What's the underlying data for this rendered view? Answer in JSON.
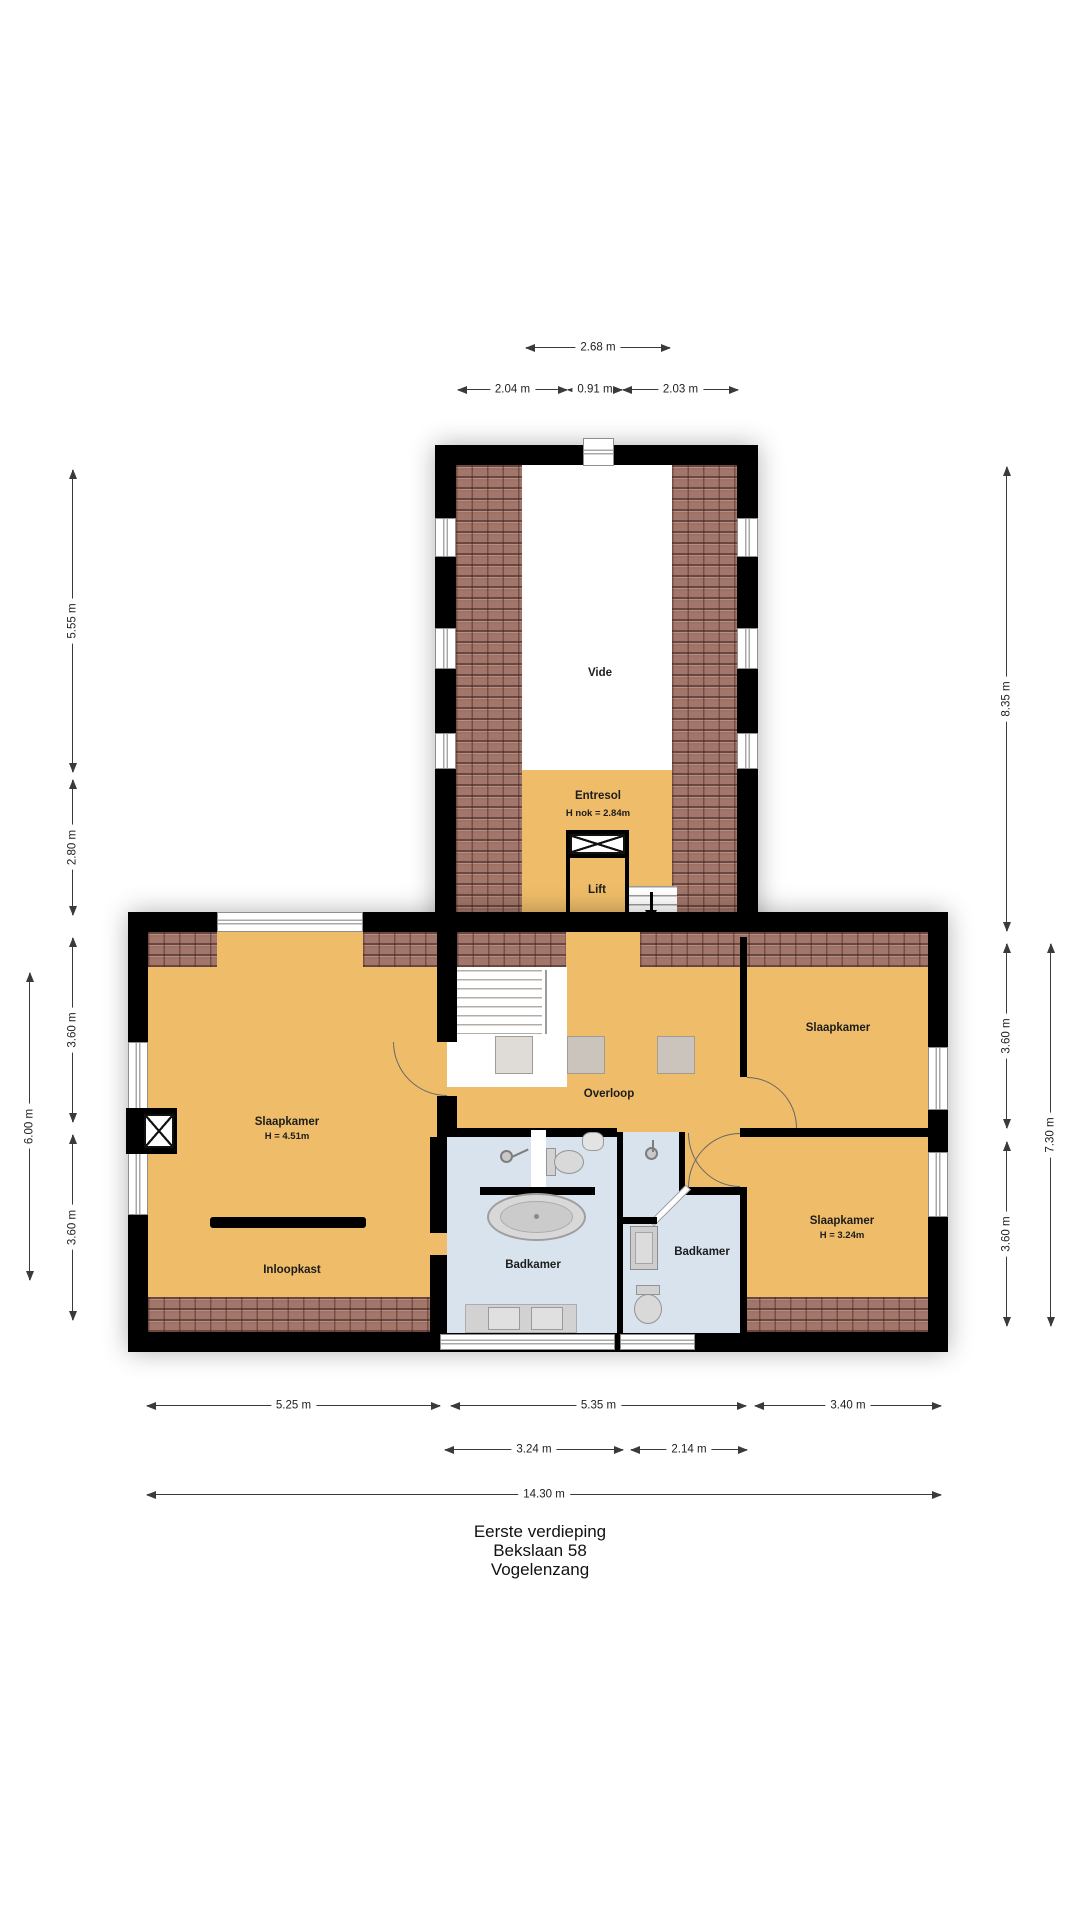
{
  "title": {
    "line1": "Eerste verdieping",
    "line2": "Bekslaan 58",
    "line3": "Vogelenzang"
  },
  "rooms": {
    "vide": "Vide",
    "entresol": "Entresol",
    "entresol_height": "H nok = 2.84m",
    "lift": "Lift",
    "slaapkamer_left": "Slaapkamer",
    "slaapkamer_left_height": "H = 4.51m",
    "inloopkast": "Inloopkast",
    "overloop": "Overloop",
    "slaapkamer_right_top": "Slaapkamer",
    "badkamer_main": "Badkamer",
    "badkamer_small": "Badkamer",
    "slaapkamer_right_bottom": "Slaapkamer",
    "slaapkamer_right_bottom_height": "H = 3.24m"
  },
  "dimensions": {
    "w_total_top": "2.68 m",
    "w_top_left": "2.04 m",
    "w_top_mid": "0.91 m",
    "w_top_right": "2.03 m",
    "h_vide": "5.55 m",
    "h_entresol": "2.80 m",
    "h_left_upper": "3.60 m",
    "h_left_total": "6.00 m",
    "h_left_lower": "3.60 m",
    "h_tower_right": "8.35 m",
    "h_right_upper": "3.60 m",
    "h_right_total": "7.30 m",
    "h_right_lower": "3.60 m",
    "w_bottom_left": "5.25 m",
    "w_bottom_mid": "5.35 m",
    "w_bottom_right": "3.40 m",
    "w_bath_left": "3.24 m",
    "w_bath_right": "2.14 m",
    "w_total_bottom": "14.30 m"
  },
  "colors": {
    "wall": "#000000",
    "floor_orange": "#efbd69",
    "bathroom_blue": "#d8e3ee",
    "roof_tiles": "#a2766a",
    "fixture_gray": "#d2d2d2",
    "dimension_text": "#1e1e1e"
  }
}
